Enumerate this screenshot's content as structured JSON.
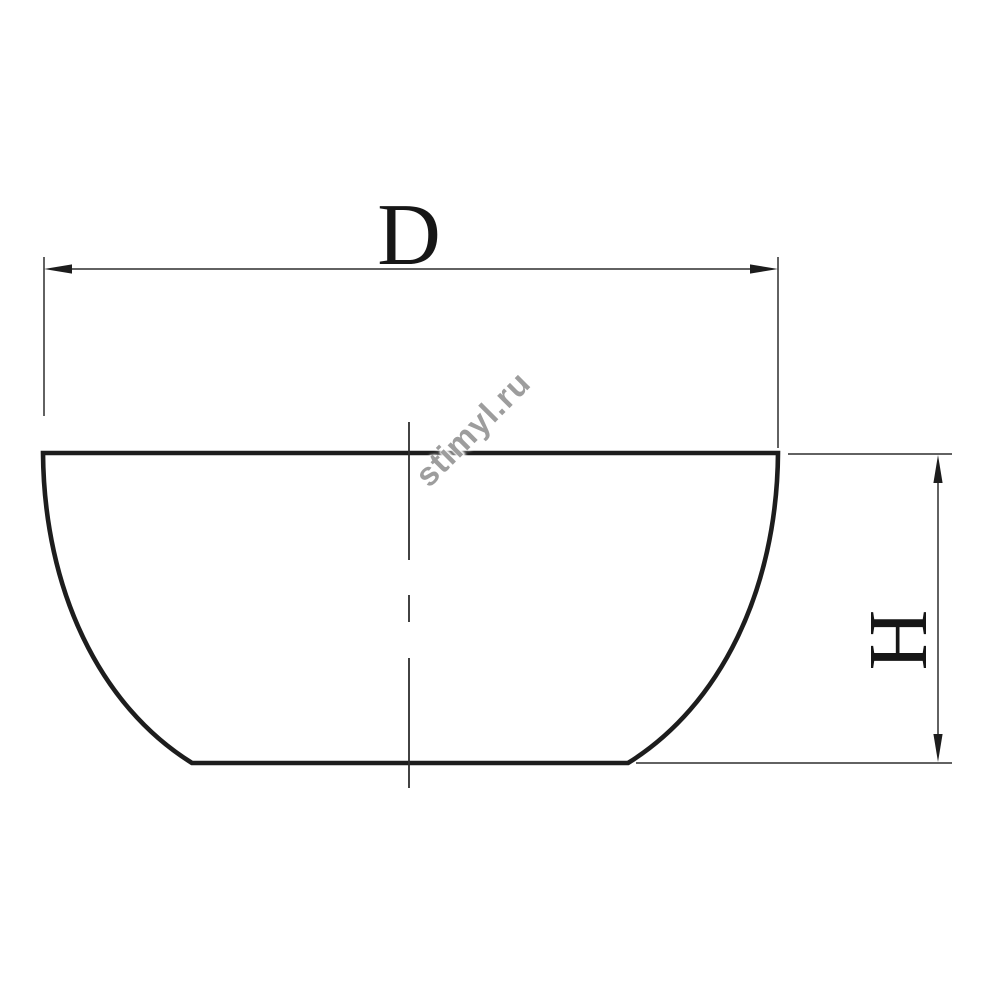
{
  "labels": {
    "diameter": "D",
    "height": "H"
  },
  "watermark": {
    "text": "stimyl.ru"
  },
  "colors": {
    "outline": "#1d1d1d",
    "thin_line": "#2e2e2e",
    "label_text": "#161616",
    "watermark_text": "#9d9d9d",
    "background": "#ffffff"
  }
}
